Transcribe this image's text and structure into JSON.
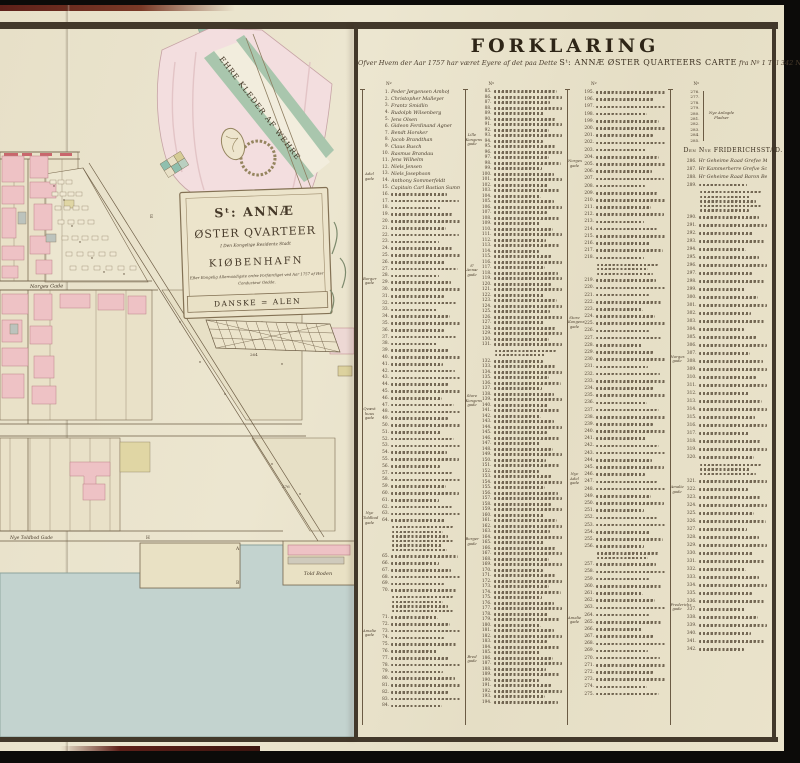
{
  "colors": {
    "photo_bg": "#0c0b09",
    "paper": "#e9e2cb",
    "ink": "#42382a",
    "pink_building": "#eec2c5",
    "red_dash": "#c9666c",
    "yellow_parcel": "#ddd29e",
    "water": "#c3d3cf",
    "flag_green": "#a9c6ad",
    "drapery_pink": "#f3dedf",
    "book_edge_maroon": "#5e2019"
  },
  "map": {
    "banner_text": "EHRE KLEDER AF WEHRE",
    "cartouche": {
      "line1": "Sᵗ: ANNÆ",
      "line2": "ØSTER QVARTEER",
      "line3": "I Den Kongelige Residentz Stadt",
      "line4": "KIØBENHAFN",
      "line5": "Efter Kongelig Allernaadigste ordre Forfærdiget ved Aar 1757 af Her",
      "line6": "Conducteur Gedde.",
      "scale_label": "DANSKE = ALEN"
    },
    "street_labels": {
      "norges": "Norges Gade",
      "toldbod": "Nye Toldbod Gade",
      "toldboden": "Told Boden"
    },
    "parcel_numbers": {
      "p1": "264",
      "p2": "276"
    },
    "letters": [
      {
        "t": "E"
      },
      {
        "t": "G"
      },
      {
        "t": "H"
      },
      {
        "t": "A"
      },
      {
        "t": "B"
      }
    ]
  },
  "legend": {
    "title": "FORKLARING",
    "subtitle_pre": "Ofver Hvem der Aar 1757 har været Eyere af det paa Dette",
    "subtitle_caps": "Sᵗ: ANNÆ ØSTER QUARTEERS CARTE",
    "subtitle_post": "fra Nº 1 Till 342 Nummerede Huuse.",
    "no_label": "Nº",
    "columns": [
      {
        "start": 1,
        "end": 84,
        "named_entries": [
          {
            "n": 1,
            "name": "Peder Jørgensen Amhof"
          },
          {
            "n": 2,
            "name": "Christopher Malleyer"
          },
          {
            "n": 3,
            "name": "Frantz Smidlin"
          },
          {
            "n": 4,
            "name": "Rudolph Wilsenberg"
          },
          {
            "n": 5,
            "name": "Jens Olsen"
          },
          {
            "n": 6,
            "name": "Gideon Ferdinand Agner"
          },
          {
            "n": 7,
            "name": "Bendt Horsker"
          },
          {
            "n": 8,
            "name": "Jacob Brandthan"
          },
          {
            "n": 9,
            "name": "Claus Busch"
          },
          {
            "n": 10,
            "name": "Rasmus Brandau"
          },
          {
            "n": 11,
            "name": "Jens Wilhelm"
          },
          {
            "n": 12,
            "name": "Niels Jensen"
          },
          {
            "n": 13,
            "name": "Niels Josephson"
          },
          {
            "n": 14,
            "name": "Anthony Sommerfeldt"
          },
          {
            "n": 15,
            "name": "Capitain Carl Bastian Summ"
          }
        ],
        "paras": [
          {
            "at": 64,
            "lines": 6
          },
          {
            "at": 70,
            "lines": 4
          }
        ],
        "margin_labels": [
          {
            "text": "Adel gade",
            "top": 14
          },
          {
            "text": "Borger gade",
            "top": 30
          },
          {
            "text": "Qvæst huus gade",
            "top": 50
          },
          {
            "text": "Nye Toldbod gade",
            "top": 66
          },
          {
            "text": "Amalie gade",
            "top": 84
          }
        ]
      },
      {
        "start": 85,
        "end": 194,
        "named_entries": [],
        "paras": [
          {
            "at": 131,
            "lines": 2
          }
        ],
        "margin_labels": [
          {
            "text": "Lille Kongens gade",
            "top": 8
          },
          {
            "text": "Sᵗ Annæ gade",
            "top": 28
          },
          {
            "text": "Store Kongens gade",
            "top": 48
          },
          {
            "text": "Borger gade",
            "top": 70
          },
          {
            "text": "Bred gade",
            "top": 88
          }
        ]
      },
      {
        "start": 195,
        "end": 275,
        "named_entries": [],
        "paras": [
          {
            "at": 218,
            "lines": 3
          },
          {
            "at": 256,
            "lines": 2
          }
        ],
        "margin_labels": [
          {
            "text": "Norges gade",
            "top": 12
          },
          {
            "text": "Store Kongens gade",
            "top": 36
          },
          {
            "text": "Nye Adel gade",
            "top": 60
          },
          {
            "text": "Amalie gade",
            "top": 82
          }
        ]
      },
      {
        "start": 286,
        "end": 342,
        "pre_numbers": [
          276,
          277,
          278,
          279,
          280,
          281,
          282,
          283,
          284,
          285
        ],
        "pre_label": "Nye Anlagde Pladser",
        "header": "Den Nye FRIDERICHSSTAD.",
        "named_entries": [
          {
            "n": 286,
            "name": "Hr Geheime Raad Grefve Moltkes Hotel"
          },
          {
            "n": 287,
            "name": "Hr Kammerherre Grefve Schacks Hotel"
          },
          {
            "n": 288,
            "name": "Hr Geheime Raad Baron Bernstorffs Hotel"
          }
        ],
        "paras": [
          {
            "at": 289,
            "lines": 5
          },
          {
            "at": 320,
            "lines": 3
          }
        ],
        "margin_labels": [
          {
            "text": "Norges gade",
            "top": 42
          },
          {
            "text": "Amalie gade",
            "top": 62
          },
          {
            "text": "Frederichs gade",
            "top": 80
          }
        ]
      }
    ]
  }
}
